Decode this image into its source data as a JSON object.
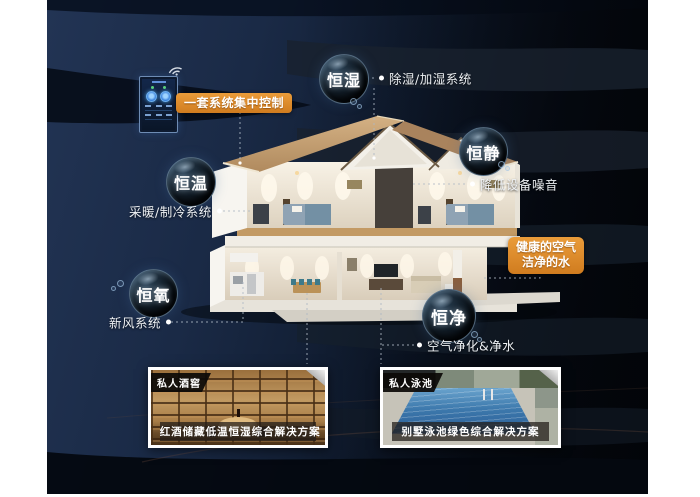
{
  "scene": {
    "control": {
      "label": "一套系统集中控制"
    },
    "benefit": {
      "line1": "健康的空气",
      "line2": "洁净的水"
    },
    "bubbles": [
      {
        "label": "恒湿",
        "desc": "除湿/加湿系统"
      },
      {
        "label": "恒静",
        "desc": "降低设备噪音"
      },
      {
        "label": "恒温",
        "desc": "采暖/制冷系统"
      },
      {
        "label": "恒氧",
        "desc": "新风系统"
      },
      {
        "label": "恒净",
        "desc": "空气净化&净水"
      }
    ],
    "cards": [
      {
        "badge": "私人酒窖",
        "caption": "红酒储藏低温恒湿综合解决方案"
      },
      {
        "badge": "私人泳池",
        "caption": "别墅泳池绿色综合解决方案"
      }
    ],
    "colors": {
      "accent_orange": "#DD8C2F",
      "bg_navy": "#1C2D4C",
      "bg_dark": "#05080E"
    }
  }
}
